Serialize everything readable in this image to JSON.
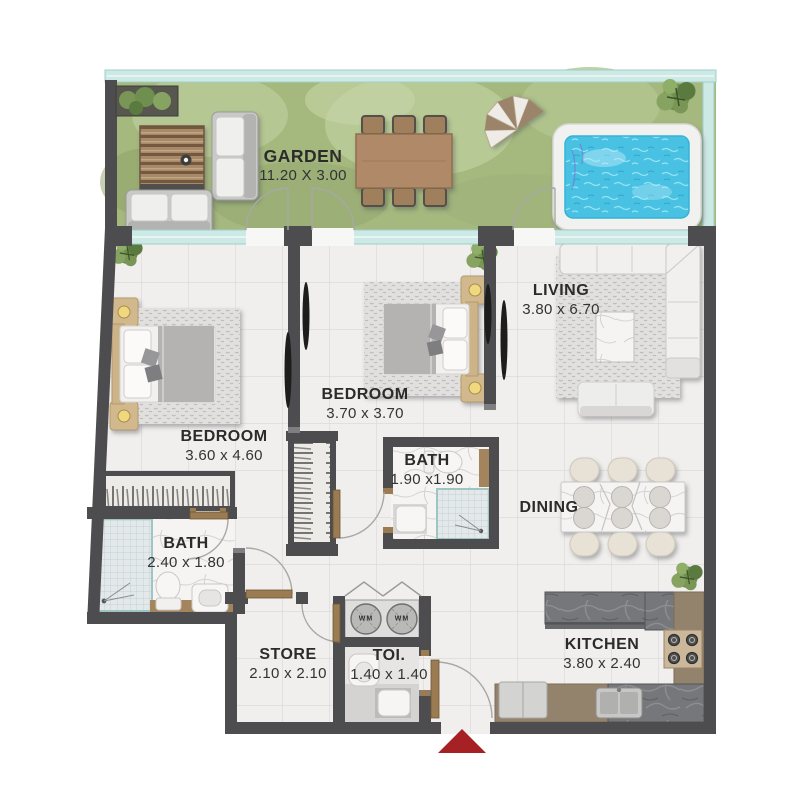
{
  "rooms": {
    "garden": {
      "label": "GARDEN",
      "dims": "11.20 X 3.00"
    },
    "bedroom_left": {
      "label": "BEDROOM",
      "dims": "3.60 x 4.60"
    },
    "bedroom_middle": {
      "label": "BEDROOM",
      "dims": "3.70 x 3.70"
    },
    "living": {
      "label": "LIVING",
      "dims": "3.80 x 6.70"
    },
    "bath_middle": {
      "label": "BATH",
      "dims": "1.90 x1.90"
    },
    "bath_left": {
      "label": "BATH",
      "dims": "2.40 x 1.80"
    },
    "dining": {
      "label": "DINING"
    },
    "store": {
      "label": "STORE",
      "dims": "2.10 x 2.10"
    },
    "toilet": {
      "label": "TOI.",
      "dims": "1.40 x 1.40"
    },
    "kitchen": {
      "label": "KITCHEN",
      "dims": "3.80 x 2.40"
    }
  },
  "laundry": {
    "washer1": "WM",
    "washer2": "WM"
  },
  "colors": {
    "wall": "#4d4d4f",
    "garden_green": "#a5b87e",
    "glass": "#cde9e6",
    "pool_water": "#49c1e3",
    "floor_tile": "#f0efed",
    "entry_arrow": "#a62124",
    "text": "#2b2b2b"
  }
}
